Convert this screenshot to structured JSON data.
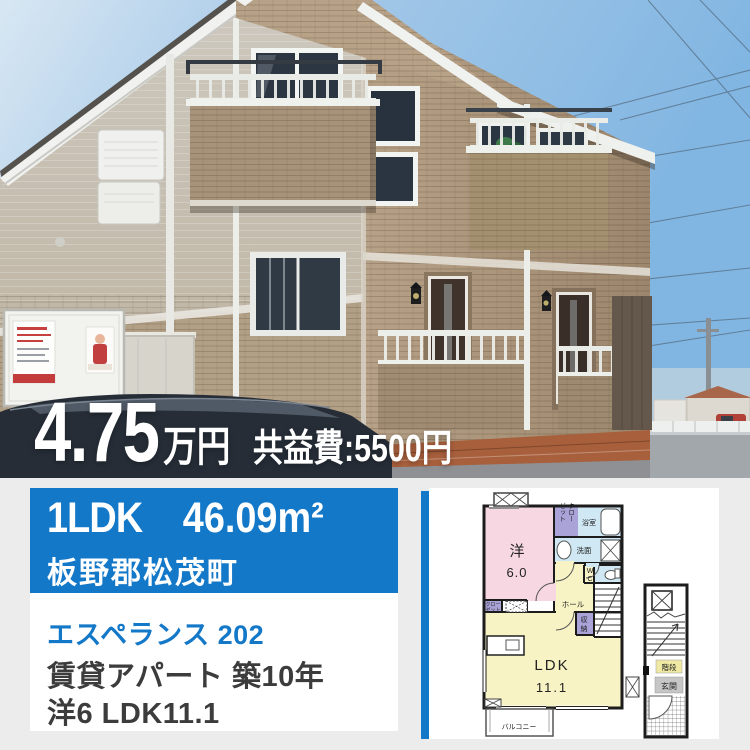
{
  "photo": {
    "price_value": "4.75",
    "price_unit": "万円",
    "common_fee_label": "共益費:5500円"
  },
  "banner": {
    "layout": "1LDK",
    "area": "46.09m²",
    "location": "板野郡松茂町"
  },
  "details": {
    "property_name": "エスペランス 202",
    "property_type_age": "賃貸アパート 築10年",
    "room_composition": "洋6 LDK11.1"
  },
  "floorplan": {
    "western_room_label": "洋",
    "western_room_size": "6.0",
    "closet_top_col1": "クロー",
    "closet_top_col2": "ゼット",
    "bath_label": "浴室",
    "wash_label": "洗面",
    "wc_line1": "W",
    "wc_line2": "C",
    "hall_label": "ホール",
    "storage_line1": "収",
    "storage_line2": "納",
    "closet2_line1": "クロー",
    "closet2_line2": "ゼット",
    "ldk_label": "LDK",
    "ldk_size": "11.1",
    "balcony_label": "バルコニー",
    "stairs_label": "階段",
    "entrance_label": "玄関"
  },
  "colors": {
    "accent_blue": "#1478c8",
    "sky_blue": "#8fc0e6",
    "brick_tan": "#b29d82",
    "plan_pink": "#f7d7e1",
    "plan_yellow": "#f7f3c4",
    "plan_blue": "#cfe8f4",
    "plan_purple": "#a9a3d8"
  }
}
